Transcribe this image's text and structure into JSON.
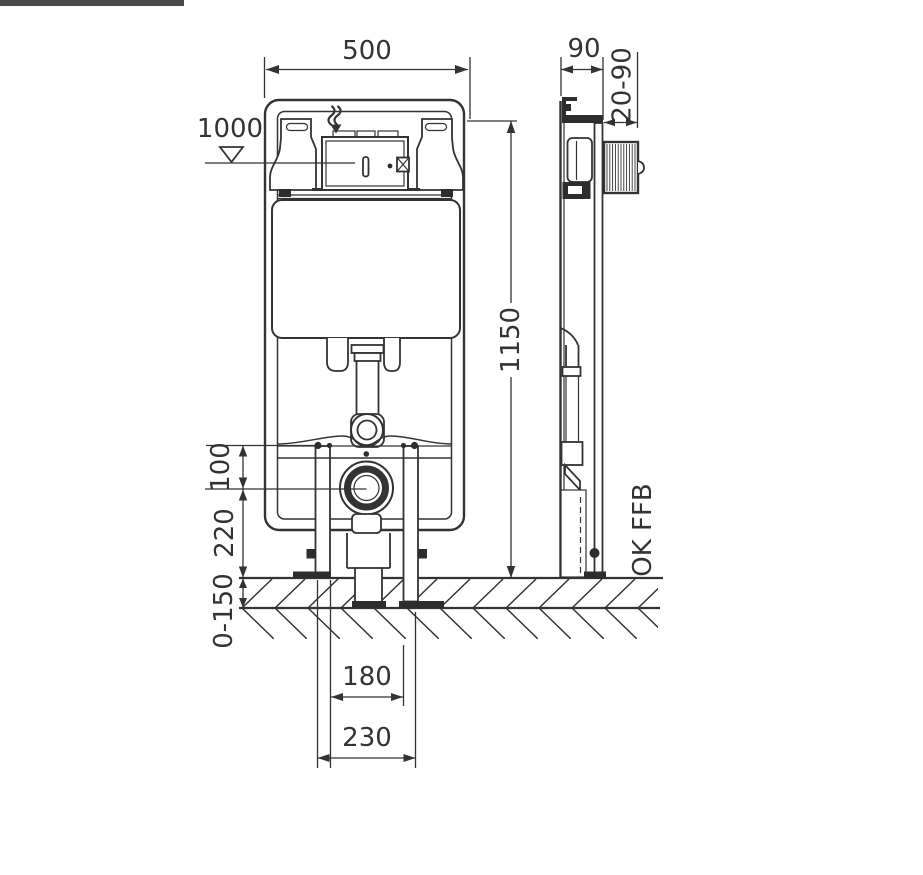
{
  "page": {
    "background": "#ffffff",
    "top_bar_color": "#4a4848",
    "line_color": "#333333"
  },
  "drawing": {
    "type": "installation-dimension-drawing",
    "subject": "concealed WC cistern mounting frame, front and side view",
    "front_view": {
      "dim_width": "500",
      "dim_height": "1150",
      "dim_actuation_level": "1000",
      "dim_anchor_to_outlet": "100",
      "dim_outlet_height": "220",
      "dim_floor_buildup": "0-150",
      "dim_inner_spacing": "180",
      "dim_outer_spacing": "230"
    },
    "side_view": {
      "dim_depth": "90",
      "dim_front_adjust": "20-90",
      "floor_reference": "OK FFB"
    },
    "icons": {
      "level_marker": "inverted-triangle",
      "water_inlet": "wavy-down-arrow"
    }
  }
}
